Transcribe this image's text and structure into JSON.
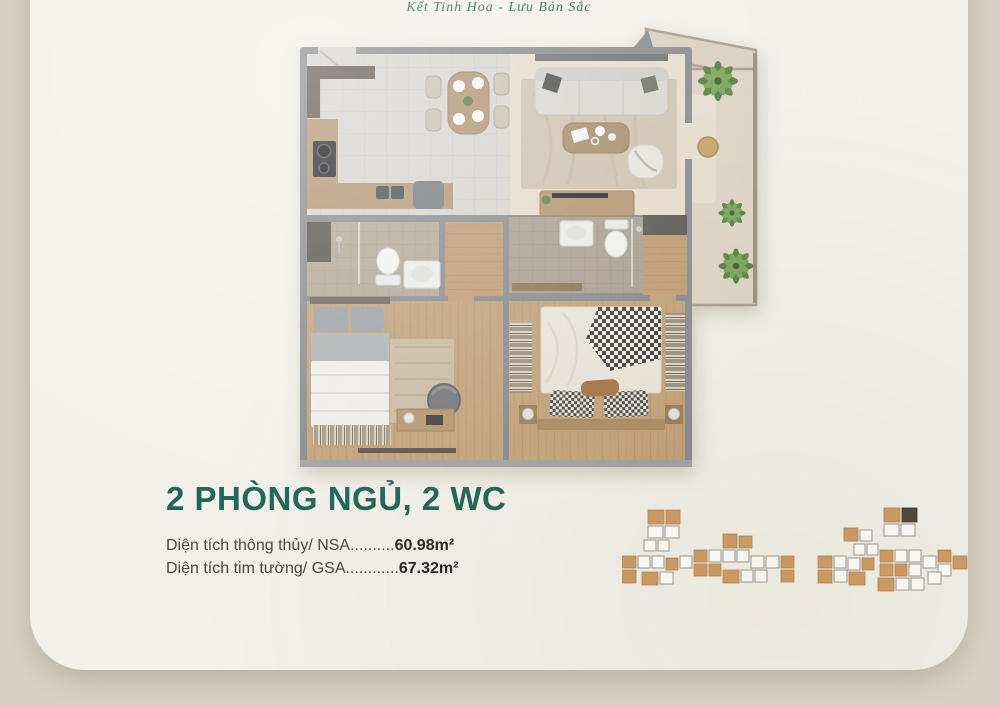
{
  "logo": {
    "title": "THE EMERALD",
    "subtitle": "GARDEN VIEW",
    "subtitle_parts": {
      "before_a": "G",
      "after_a": "RDEN VIEW"
    },
    "tagline": "Kết Tinh Hoa - Lưu Bản Sắc"
  },
  "info": {
    "headline": "2 PHÒNG NGỦ, 2 WC",
    "specs": [
      {
        "label": "Diện tích thông thủy/ NSA",
        "dots": "..........",
        "value": "60.98m²"
      },
      {
        "label": "Diện tích tim tường/ GSA",
        "dots": "............",
        "value": "67.32m²"
      }
    ]
  },
  "floorplan": {
    "type": "apartment-top-down-render",
    "rooms": [
      "kitchen-dining",
      "living-room",
      "balcony",
      "bathroom-2",
      "corridor",
      "master-bathroom",
      "bedroom-2",
      "master-bedroom"
    ]
  },
  "keyplan": {
    "blocks": 2,
    "note": "site key plan, highlighted units in tan, current unit dark"
  },
  "colors": {
    "background": "#d7d0c3",
    "card": "#f2f0e8",
    "brand_green": "#1d6150",
    "logo_gold": "#c9a15b",
    "headline_green": "#156052",
    "spec_text": "#454540",
    "keyplan_unit": "#cd9a62",
    "keyplan_current": "#4e4237"
  }
}
